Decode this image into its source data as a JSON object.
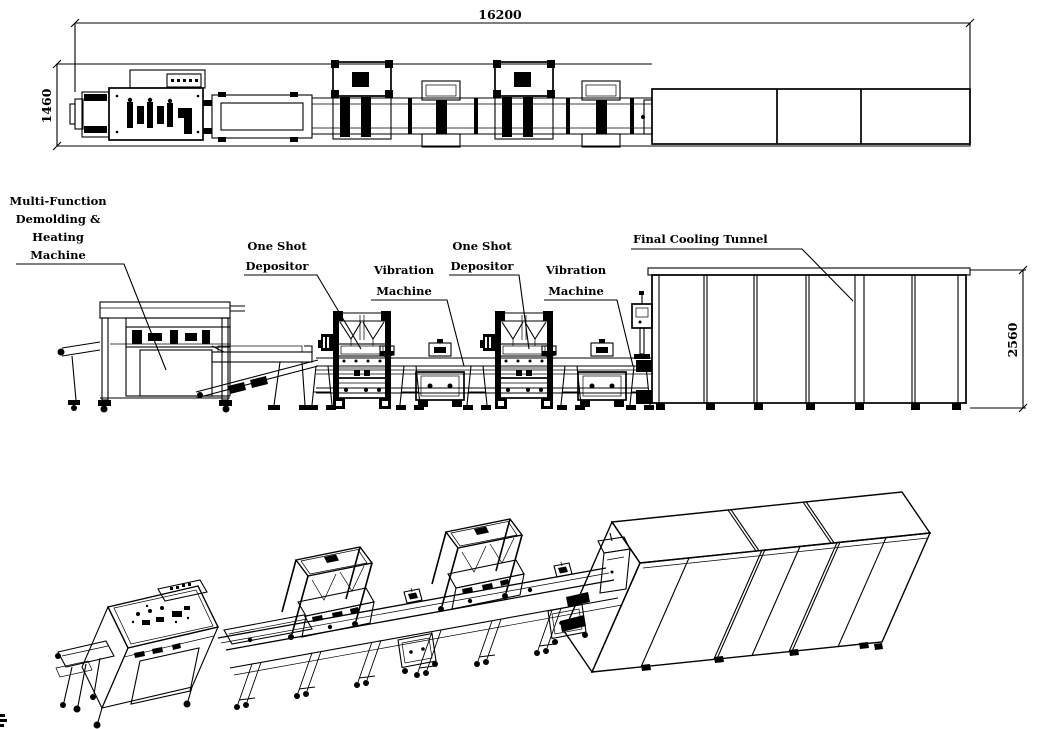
{
  "dimensions": {
    "overall_length": "16200",
    "line_width": "1460",
    "tunnel_height": "2560"
  },
  "labels": {
    "demolding": [
      "Multi-Function",
      "Demolding &",
      "Heating",
      "Machine"
    ],
    "depositor_1": [
      "One Shot",
      "Depositor"
    ],
    "vibration_1": [
      "Vibration",
      "Machine"
    ],
    "depositor_2": [
      "One Shot",
      "Depositor"
    ],
    "vibration_2": [
      "Vibration",
      "Machine"
    ],
    "cooling_tunnel": "Final Cooling Tunnel"
  },
  "colors": {
    "ink": "#000000",
    "paper": "#ffffff"
  }
}
